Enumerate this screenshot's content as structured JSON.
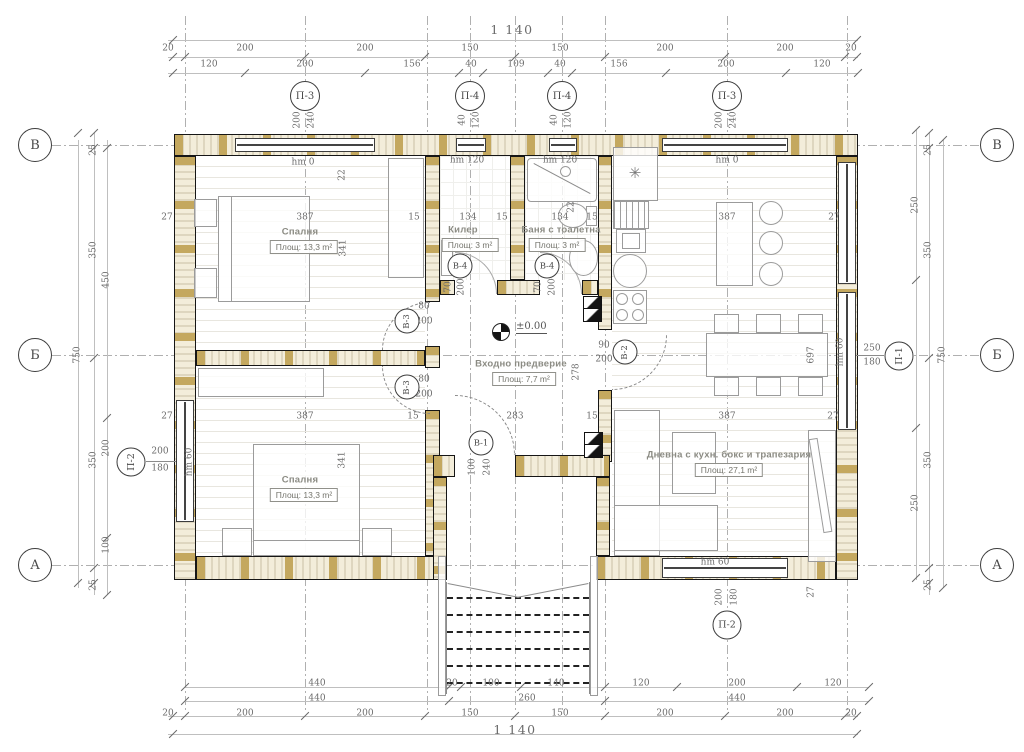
{
  "drawing": {
    "type_label": "architectural floor plan",
    "elevation": {
      "label": "±0.00"
    },
    "symbols": {
      "fridge_symbol": "✳"
    }
  },
  "rooms": [
    {
      "name": "Спалня",
      "area": "Площ: 13,3 m²",
      "nx": 300,
      "ny": 232,
      "bx": 304,
      "by": 247
    },
    {
      "name": "Килер",
      "area": "Площ: 3 m²",
      "nx": 463,
      "ny": 230,
      "bx": 470,
      "by": 245
    },
    {
      "name": "Баня с тоалетна",
      "area": "Площ: 3 m²",
      "nx": 561,
      "ny": 230,
      "bx": 557,
      "by": 245
    },
    {
      "name": "Входно предверие",
      "area": "Площ: 7,7 m²",
      "nx": 521,
      "ny": 364,
      "bx": 524,
      "by": 379
    },
    {
      "name": "Дневна с кухн. бокс и трапезария",
      "area": "Площ:        27,1 m²",
      "nx": 729,
      "ny": 455,
      "bx": 729,
      "by": 470
    },
    {
      "name": "Спалня",
      "area": "Площ: 13,3 m²",
      "nx": 300,
      "ny": 480,
      "bx": 304,
      "by": 495
    }
  ],
  "axis_markers": {
    "top": [
      {
        "label": "П-3",
        "x": 305
      },
      {
        "label": "П-4",
        "x": 470
      },
      {
        "label": "П-4",
        "x": 562
      },
      {
        "label": "П-3",
        "x": 727
      }
    ],
    "rows": [
      {
        "label": "В",
        "y": 145
      },
      {
        "label": "Б",
        "y": 355
      },
      {
        "label": "А",
        "y": 565
      }
    ],
    "windows": [
      {
        "label": "П-2",
        "x": 131,
        "y": 462,
        "rot": true
      },
      {
        "label": "П-1",
        "x": 899,
        "y": 356,
        "rot": true
      },
      {
        "label": "П-2",
        "x": 727,
        "y": 625,
        "rot": false
      }
    ],
    "doors": [
      {
        "label": "В-3",
        "x": 407,
        "y": 321,
        "rot": true
      },
      {
        "label": "В-3",
        "x": 407,
        "y": 387,
        "rot": true
      },
      {
        "label": "В-4",
        "x": 460,
        "y": 266,
        "rot": false
      },
      {
        "label": "В-4",
        "x": 547,
        "y": 266,
        "rot": false
      },
      {
        "label": "В-1",
        "x": 481,
        "y": 443,
        "rot": false
      },
      {
        "label": "В-2",
        "x": 625,
        "y": 352,
        "rot": true
      }
    ]
  },
  "dim_labels": [
    {
      "t": "1 140",
      "x": 512,
      "y": 30,
      "big": true
    },
    {
      "t": "20",
      "x": 168,
      "y": 49
    },
    {
      "t": "200",
      "x": 245,
      "y": 49
    },
    {
      "t": "200",
      "x": 365,
      "y": 49
    },
    {
      "t": "150",
      "x": 470,
      "y": 49
    },
    {
      "t": "150",
      "x": 560,
      "y": 49
    },
    {
      "t": "200",
      "x": 665,
      "y": 49
    },
    {
      "t": "200",
      "x": 785,
      "y": 49
    },
    {
      "t": "20",
      "x": 851,
      "y": 49
    },
    {
      "t": "120",
      "x": 209,
      "y": 65
    },
    {
      "t": "200",
      "x": 305,
      "y": 65
    },
    {
      "t": "156",
      "x": 412,
      "y": 65
    },
    {
      "t": "40",
      "x": 471,
      "y": 65
    },
    {
      "t": "109",
      "x": 516,
      "y": 65
    },
    {
      "t": "40",
      "x": 560,
      "y": 65
    },
    {
      "t": "156",
      "x": 619,
      "y": 65
    },
    {
      "t": "200",
      "x": 726,
      "y": 65
    },
    {
      "t": "120",
      "x": 822,
      "y": 65
    },
    {
      "t": "200",
      "x": 298,
      "y": 120,
      "v": true
    },
    {
      "t": "240",
      "x": 312,
      "y": 120,
      "v": true
    },
    {
      "t": "40",
      "x": 463,
      "y": 120,
      "v": true
    },
    {
      "t": "120",
      "x": 477,
      "y": 120,
      "v": true
    },
    {
      "t": "40",
      "x": 555,
      "y": 120,
      "v": true
    },
    {
      "t": "120",
      "x": 569,
      "y": 120,
      "v": true
    },
    {
      "t": "200",
      "x": 720,
      "y": 120,
      "v": true
    },
    {
      "t": "240",
      "x": 734,
      "y": 120,
      "v": true
    },
    {
      "t": "440",
      "x": 317,
      "y": 684
    },
    {
      "t": "20",
      "x": 452,
      "y": 684
    },
    {
      "t": "100",
      "x": 491,
      "y": 684
    },
    {
      "t": "140",
      "x": 556,
      "y": 684
    },
    {
      "t": "120",
      "x": 641,
      "y": 684
    },
    {
      "t": "200",
      "x": 737,
      "y": 684
    },
    {
      "t": "120",
      "x": 833,
      "y": 684
    },
    {
      "t": "440",
      "x": 317,
      "y": 699
    },
    {
      "t": "260",
      "x": 527,
      "y": 699
    },
    {
      "t": "440",
      "x": 737,
      "y": 699
    },
    {
      "t": "20",
      "x": 168,
      "y": 714
    },
    {
      "t": "200",
      "x": 245,
      "y": 714
    },
    {
      "t": "200",
      "x": 365,
      "y": 714
    },
    {
      "t": "150",
      "x": 470,
      "y": 714
    },
    {
      "t": "150",
      "x": 560,
      "y": 714
    },
    {
      "t": "200",
      "x": 665,
      "y": 714
    },
    {
      "t": "200",
      "x": 785,
      "y": 714
    },
    {
      "t": "20",
      "x": 851,
      "y": 714
    },
    {
      "t": "1 140",
      "x": 515,
      "y": 730,
      "big": true
    },
    {
      "t": "200",
      "x": 720,
      "y": 597,
      "v": true
    },
    {
      "t": "180",
      "x": 735,
      "y": 597,
      "v": true
    },
    {
      "t": "27",
      "x": 812,
      "y": 592,
      "v": true
    },
    {
      "t": "25",
      "x": 94,
      "y": 150,
      "v": true
    },
    {
      "t": "350",
      "x": 94,
      "y": 250,
      "v": true
    },
    {
      "t": "450",
      "x": 107,
      "y": 280,
      "v": true
    },
    {
      "t": "750",
      "x": 78,
      "y": 355,
      "v": true
    },
    {
      "t": "350",
      "x": 94,
      "y": 460,
      "v": true
    },
    {
      "t": "200",
      "x": 107,
      "y": 448,
      "v": true
    },
    {
      "t": "100",
      "x": 107,
      "y": 545,
      "v": true
    },
    {
      "t": "25",
      "x": 94,
      "y": 585,
      "v": true
    },
    {
      "t": "200",
      "x": 160,
      "y": 452
    },
    {
      "t": "180",
      "x": 160,
      "y": 469
    },
    {
      "t": "hm 60",
      "x": 190,
      "y": 462,
      "v": true
    },
    {
      "t": "25",
      "x": 929,
      "y": 150,
      "v": true
    },
    {
      "t": "250",
      "x": 916,
      "y": 205,
      "v": true
    },
    {
      "t": "350",
      "x": 929,
      "y": 250,
      "v": true
    },
    {
      "t": "750",
      "x": 943,
      "y": 355,
      "v": true
    },
    {
      "t": "350",
      "x": 929,
      "y": 460,
      "v": true
    },
    {
      "t": "250",
      "x": 916,
      "y": 503,
      "v": true
    },
    {
      "t": "25",
      "x": 929,
      "y": 585,
      "v": true
    },
    {
      "t": "250",
      "x": 872,
      "y": 349
    },
    {
      "t": "180",
      "x": 872,
      "y": 363
    },
    {
      "t": "hm 60",
      "x": 841,
      "y": 352,
      "v": true
    },
    {
      "t": "hm 0",
      "x": 303,
      "y": 163
    },
    {
      "t": "hm 120",
      "x": 467,
      "y": 161
    },
    {
      "t": "hm 120",
      "x": 560,
      "y": 161
    },
    {
      "t": "hm 0",
      "x": 727,
      "y": 161
    },
    {
      "t": "27",
      "x": 167,
      "y": 218
    },
    {
      "t": "387",
      "x": 305,
      "y": 218
    },
    {
      "t": "15",
      "x": 414,
      "y": 218
    },
    {
      "t": "134",
      "x": 468,
      "y": 218
    },
    {
      "t": "15",
      "x": 502,
      "y": 218
    },
    {
      "t": "134",
      "x": 560,
      "y": 218
    },
    {
      "t": "15",
      "x": 592,
      "y": 218
    },
    {
      "t": "387",
      "x": 727,
      "y": 218
    },
    {
      "t": "27",
      "x": 834,
      "y": 218
    },
    {
      "t": "22",
      "x": 343,
      "y": 175,
      "v": true
    },
    {
      "t": "341",
      "x": 344,
      "y": 248,
      "v": true
    },
    {
      "t": "22",
      "x": 572,
      "y": 207,
      "v": true
    },
    {
      "t": "80",
      "x": 424,
      "y": 307
    },
    {
      "t": "200",
      "x": 424,
      "y": 322
    },
    {
      "t": "80",
      "x": 424,
      "y": 380
    },
    {
      "t": "200",
      "x": 424,
      "y": 395
    },
    {
      "t": "70",
      "x": 449,
      "y": 287,
      "v": true
    },
    {
      "t": "200",
      "x": 462,
      "y": 287,
      "v": true
    },
    {
      "t": "70",
      "x": 539,
      "y": 287,
      "v": true
    },
    {
      "t": "200",
      "x": 553,
      "y": 287,
      "v": true
    },
    {
      "t": "90",
      "x": 604,
      "y": 346
    },
    {
      "t": "200",
      "x": 604,
      "y": 360
    },
    {
      "t": "100",
      "x": 473,
      "y": 467,
      "v": true
    },
    {
      "t": "240",
      "x": 488,
      "y": 467,
      "v": true
    },
    {
      "t": "283",
      "x": 515,
      "y": 417
    },
    {
      "t": "15",
      "x": 592,
      "y": 417
    },
    {
      "t": "278",
      "x": 577,
      "y": 372,
      "v": true
    },
    {
      "t": "27",
      "x": 167,
      "y": 417
    },
    {
      "t": "387",
      "x": 305,
      "y": 417
    },
    {
      "t": "15",
      "x": 413,
      "y": 417
    },
    {
      "t": "387",
      "x": 727,
      "y": 417
    },
    {
      "t": "27",
      "x": 833,
      "y": 417
    },
    {
      "t": "341",
      "x": 343,
      "y": 460,
      "v": true
    },
    {
      "t": "697",
      "x": 812,
      "y": 355,
      "v": true
    },
    {
      "t": "hm 60",
      "x": 715,
      "y": 563
    }
  ]
}
